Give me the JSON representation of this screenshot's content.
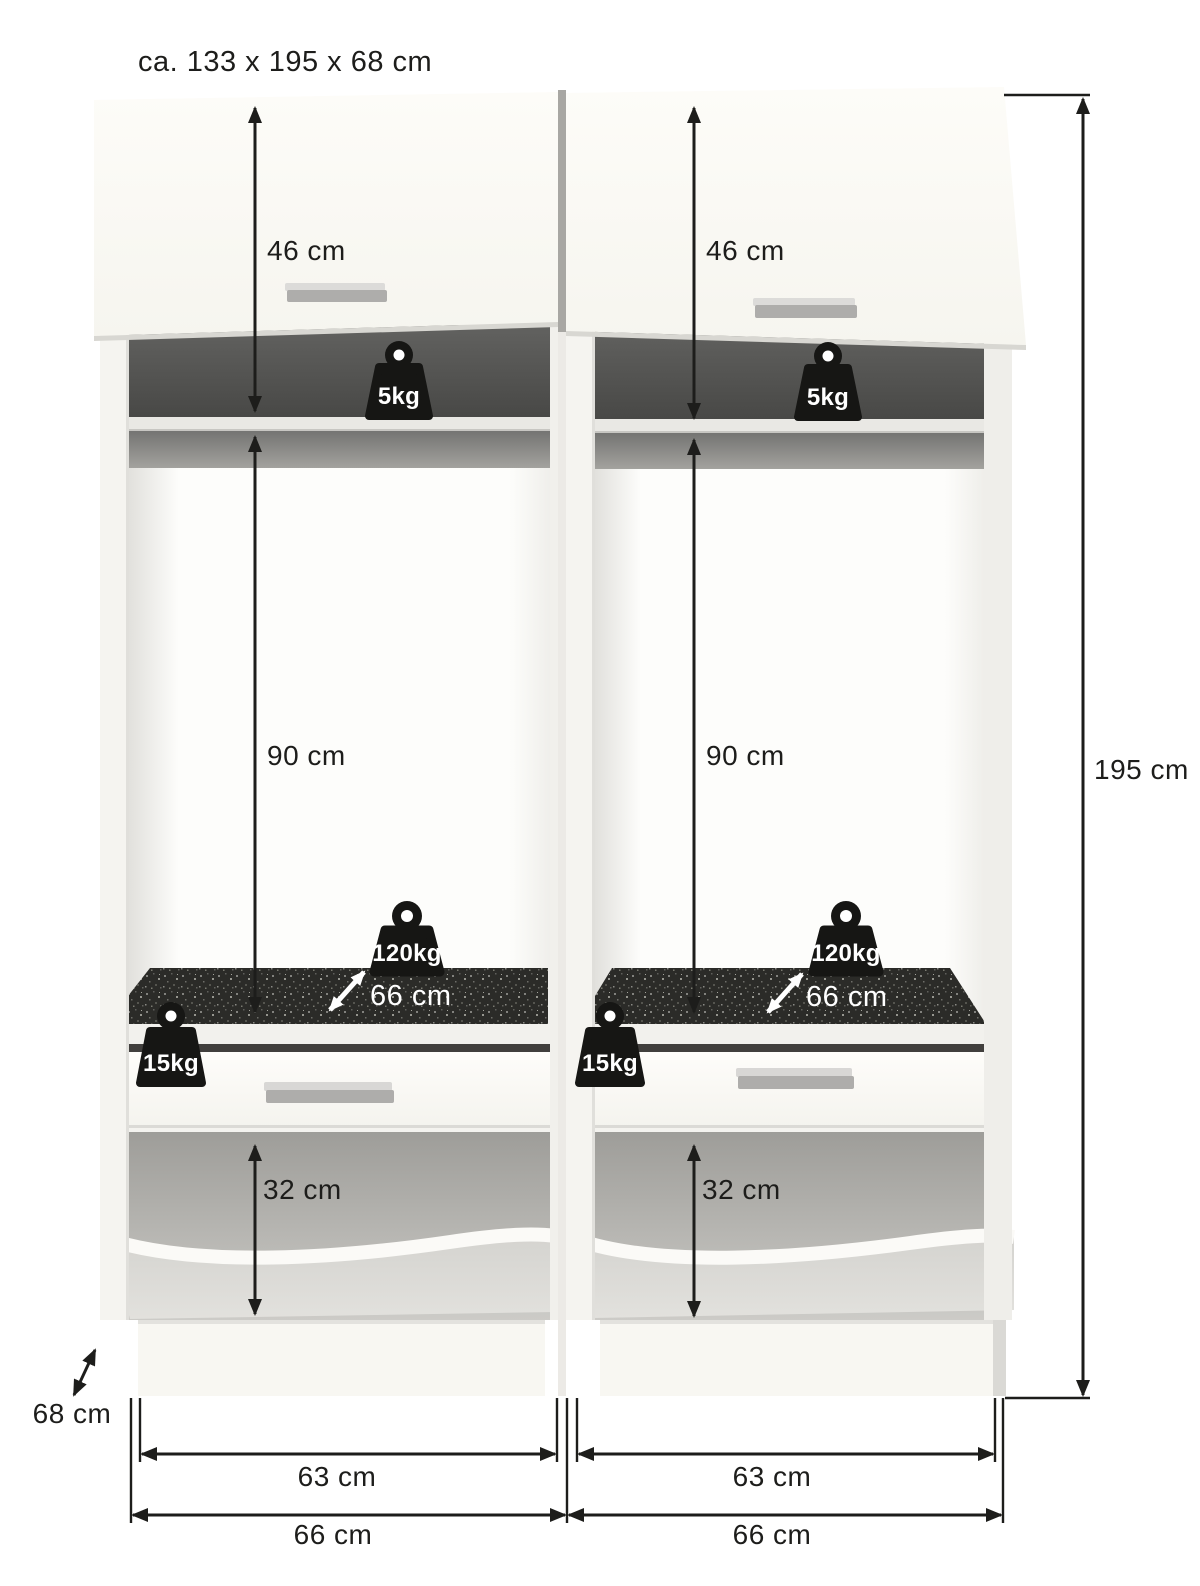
{
  "title": "ca. 133 x 195 x 68 cm",
  "units": {
    "left": {
      "flap_height": "46 cm",
      "shelf_load": "5kg",
      "niche_height": "90 cm",
      "platform_load": "120kg",
      "platform_depth": "66 cm",
      "drawer_load": "15kg",
      "bin_height": "32 cm",
      "inner_width": "63 cm",
      "outer_width": "66 cm"
    },
    "right": {
      "flap_height": "46 cm",
      "shelf_load": "5kg",
      "niche_height": "90 cm",
      "platform_load": "120kg",
      "platform_depth": "66 cm",
      "drawer_load": "15kg",
      "bin_height": "32 cm",
      "inner_width": "63 cm",
      "outer_width": "66 cm"
    }
  },
  "overall": {
    "height": "195 cm",
    "depth": "68 cm"
  },
  "colors": {
    "dimension_ink": "#1d1d1b",
    "cabinet_white": "#f8f7f2",
    "mat_dark": "#2b2b28",
    "weight_black": "#161614",
    "handle_gray": "#aeadab"
  }
}
